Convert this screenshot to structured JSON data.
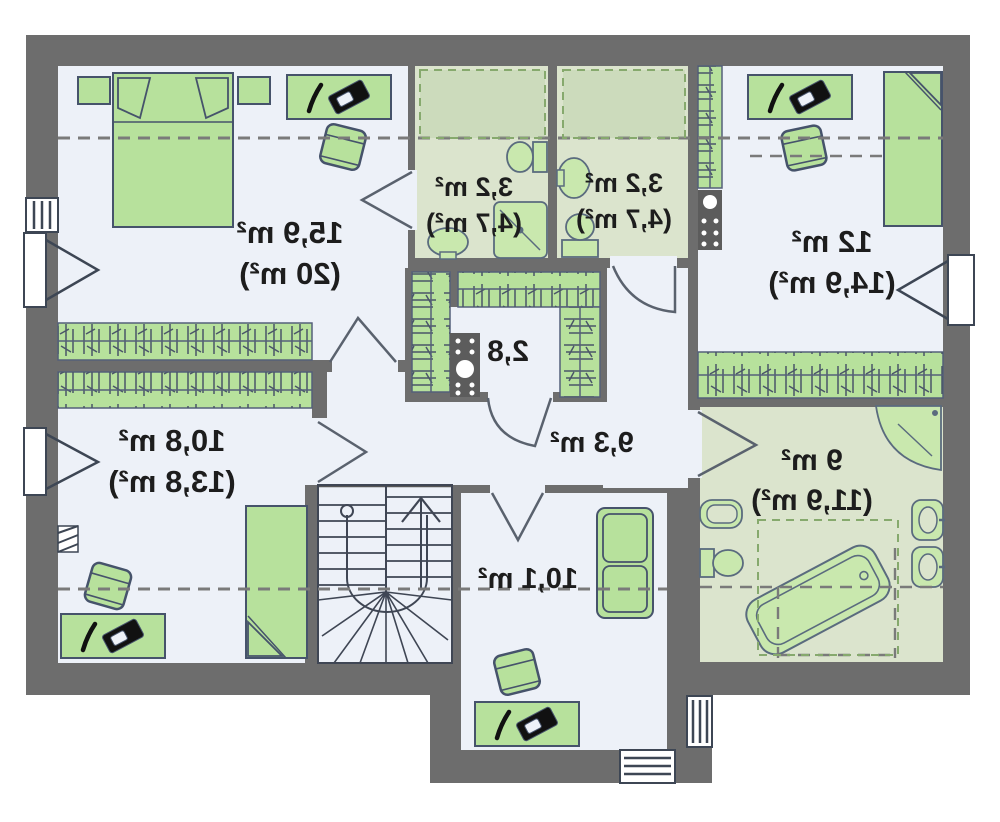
{
  "document": {
    "type": "floor-plan",
    "view": "mirrored-attic-storey",
    "units": "m²"
  },
  "rooms": [
    {
      "id": "bedroom-top-left",
      "label_area": "15,9 m²",
      "label_total": "(20 m²)"
    },
    {
      "id": "bathroom-small-left",
      "label_area": "3,2 m²",
      "label_total": "(4,7 m²)"
    },
    {
      "id": "bathroom-small-right",
      "label_area": "3,2 m²",
      "label_total": "(4,7 m²)"
    },
    {
      "id": "bedroom-top-right",
      "label_area": "12 m²",
      "label_total": "(14,9 m²)"
    },
    {
      "id": "walk-in-closet",
      "label_area": "2,8"
    },
    {
      "id": "hallway",
      "label_area": "9,3 m²"
    },
    {
      "id": "bedroom-bottom-left",
      "label_area": "10,8 m²",
      "label_total": "(13,8 m²)"
    },
    {
      "id": "room-bottom-middle",
      "label_area": "10,1 m²"
    },
    {
      "id": "bathroom-main",
      "label_area": "9 m²",
      "label_total": "(11,9 m²)"
    }
  ],
  "colors": {
    "wall": "#6d6d6d",
    "floor": "#edf1f8",
    "bath_floor": "#dbe4cd",
    "furniture": "#b7e19c",
    "fixture": "#c9e8ae",
    "outline": "#46536b",
    "dashed": "#7a7a7a",
    "dashed_green": "#86a96d",
    "text": "#1d1d1d"
  },
  "icons": [
    "bed-icon",
    "nightstand-icon",
    "desk-icon",
    "laptop-icon",
    "pen-icon",
    "chair-icon",
    "sofa-icon",
    "wardrobe-rail-icon",
    "shelf-icon",
    "chimney-icon",
    "stairs-icon",
    "door-swing-icon",
    "window-icon",
    "toilet-icon",
    "sink-icon",
    "shower-icon",
    "bathtub-icon",
    "bidet-icon",
    "vent-hatch-icon"
  ]
}
